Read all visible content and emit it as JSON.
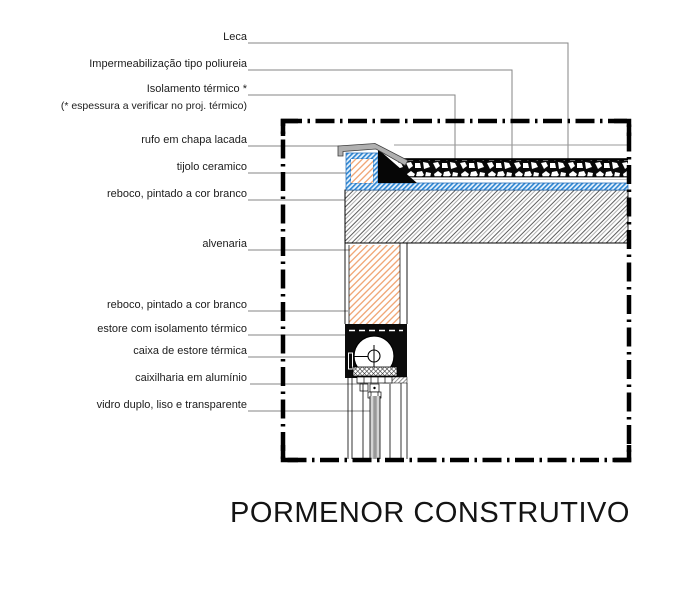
{
  "drawing": {
    "title": "PORMENOR CONSTRUTIVO",
    "labels": {
      "leca": "Leca",
      "waterproofing": "Impermeabilização tipo poliureia",
      "thermal_insulation": "Isolamento térmico *",
      "thermal_insulation_note": "(* espessura a verificar no proj. térmico)",
      "flashing": "rufo em chapa lacada",
      "ceramic_brick": "tijolo ceramico",
      "render_upper": "reboco, pintado a cor branco",
      "masonry": "alvenaria",
      "render_lower": "reboco, pintado a cor branco",
      "shutter": "estore com isolamento térmico",
      "shutter_box": "caixa de estore térmica",
      "aluminium_frame": "caixilharia em alumínio",
      "double_glazing": "vidro duplo, liso e transparente"
    },
    "colors": {
      "line_black": "#000000",
      "leader_gray": "#858585",
      "brick_hatch_orange": "#f0a473",
      "waterproofing_blue": "#2f86d2",
      "concrete_hatch_gray": "#4a4a4a",
      "flashing_gray": "#b0b0b0",
      "glass_gray": "#999999"
    }
  }
}
